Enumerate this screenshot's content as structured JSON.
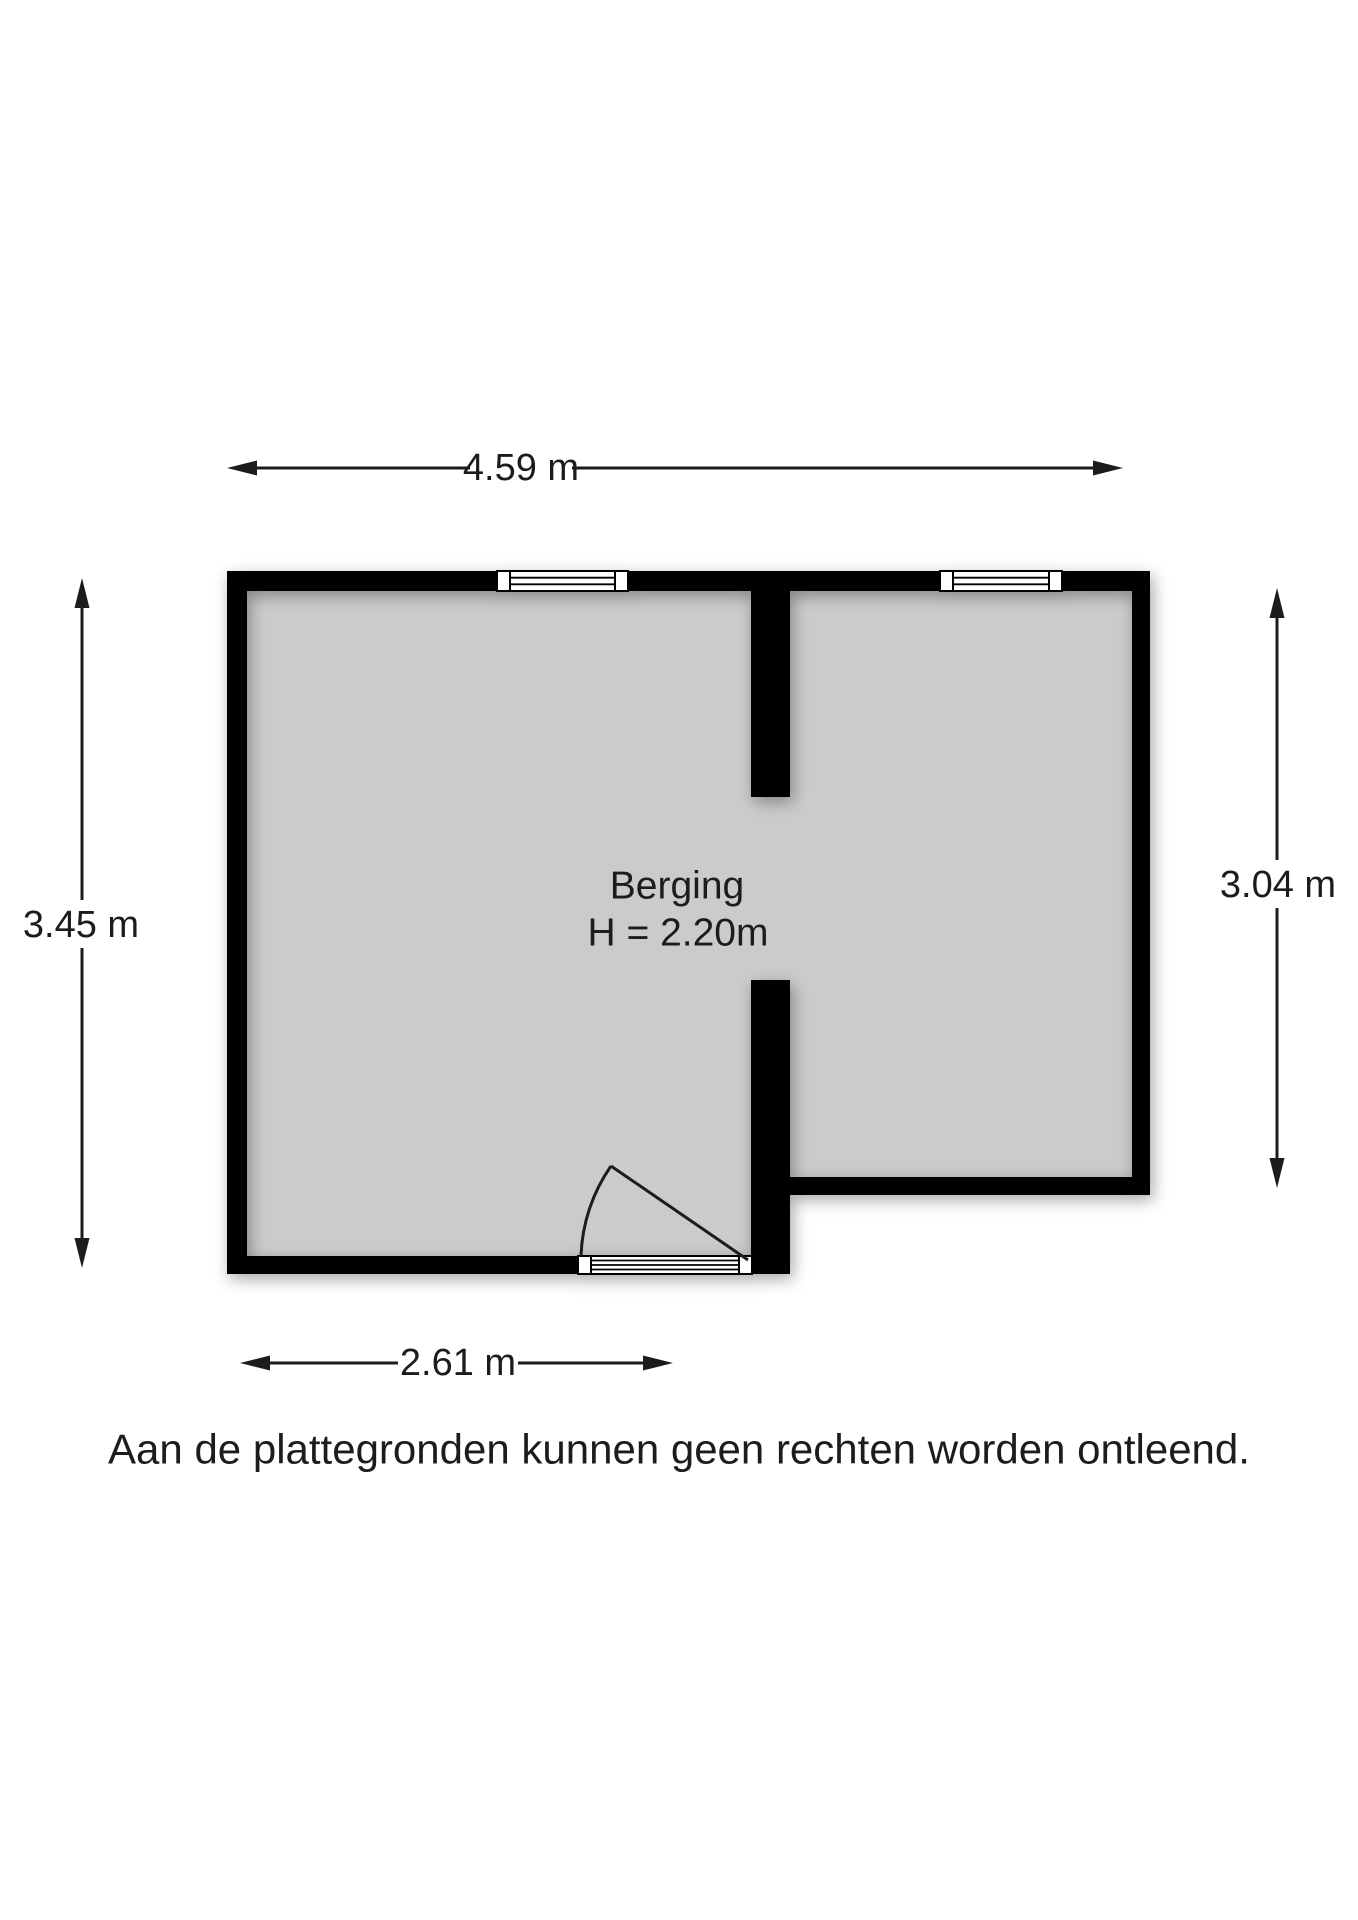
{
  "floorplan": {
    "room": {
      "name": "Berging",
      "ceiling_height_label": "H = 2.20m"
    },
    "dimensions": {
      "top_width": "4.59 m",
      "left_height": "3.45 m",
      "right_height": "3.04 m",
      "bottom_width": "2.61 m"
    },
    "disclaimer": "Aan de plattegronden kunnen geen rechten worden ontleend.",
    "colors": {
      "wall": "#000000",
      "floor": "#cbcbcb",
      "ink": "#1c1c1c",
      "window_fill": "#ffffff",
      "background": "#ffffff"
    }
  }
}
